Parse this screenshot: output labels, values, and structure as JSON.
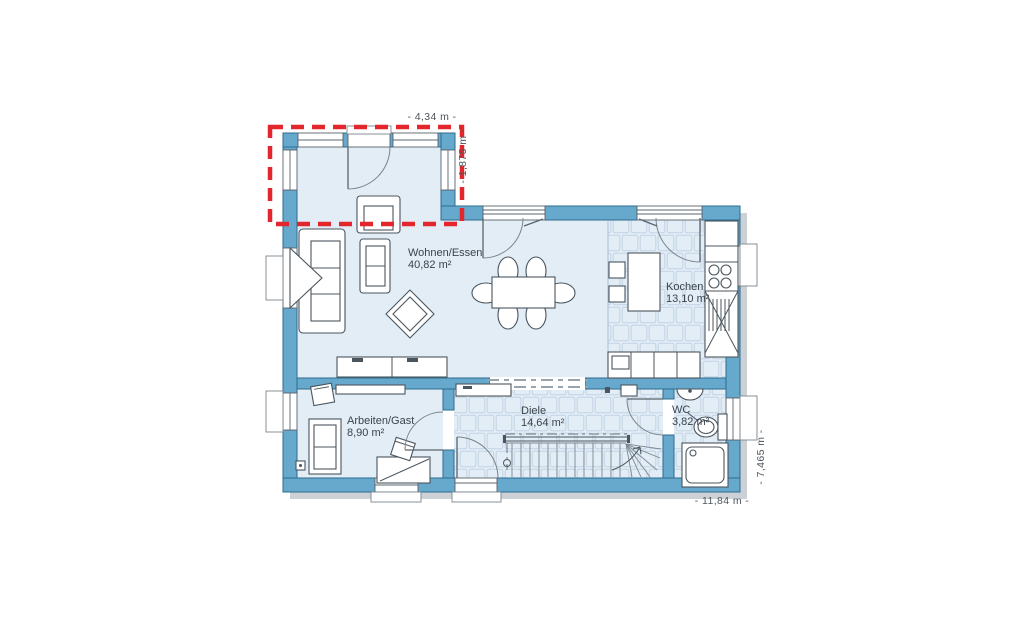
{
  "plan": {
    "rooms": {
      "wohnen": {
        "name": "Wohnen/Essen",
        "area": "40,82 m²"
      },
      "kochen": {
        "name": "Kochen",
        "area": "13,10 m²"
      },
      "arbeiten": {
        "name": "Arbeiten/Gast",
        "area": "8,90 m²"
      },
      "diele": {
        "name": "Diele",
        "area": "14,64 m²"
      },
      "wc": {
        "name": "WC",
        "area": "3,82 m²"
      }
    },
    "dimensions": {
      "top": "- 4,34 m -",
      "extension_depth": "- 1,875 m -",
      "right": "- 7,465 m -",
      "bottom": "- 11,84 m -"
    },
    "colors": {
      "wall": "#66a9cd",
      "wall_outline": "#2e6b8f",
      "floor": "#e2edf6",
      "tile_floor": "#dfe9f3",
      "tile_line": "#c2d3e3",
      "furniture_line": "#4a555e",
      "highlight": "#e2262c",
      "label_text": "#3a434c",
      "dim_text": "#4c565e",
      "shadow": "#ccd1d5"
    }
  }
}
